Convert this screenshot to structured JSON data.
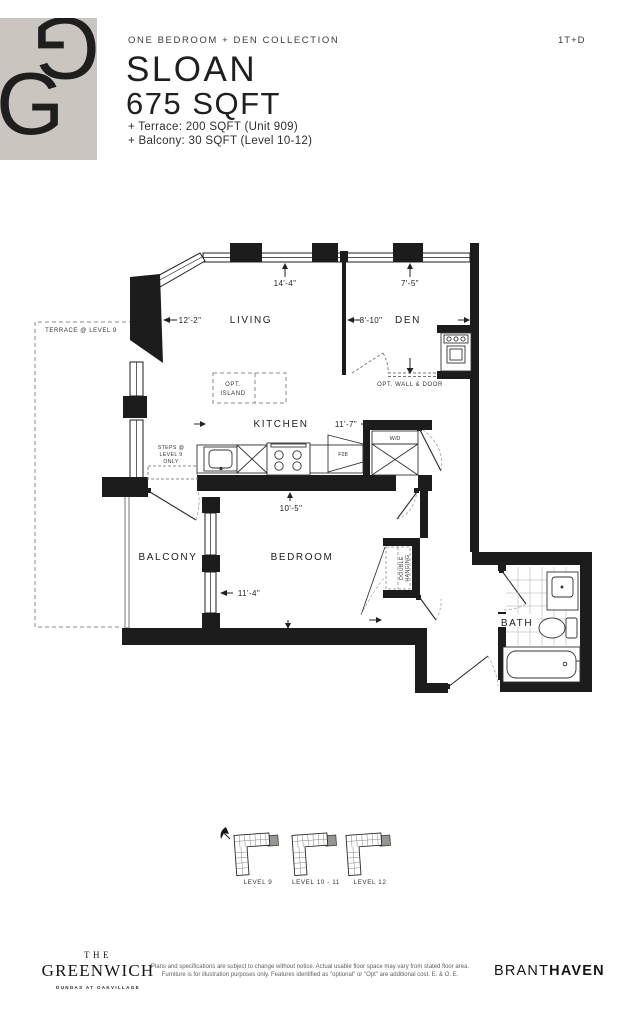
{
  "header": {
    "collection": "ONE BEDROOM + DEN COLLECTION",
    "plan_type": "1T+D",
    "name": "SLOAN",
    "area": "675 SQFT",
    "terrace_note": "+ Terrace: 200 SQFT (Unit 909)",
    "balcony_note": "+ Balcony: 30 SQFT (Level 10-12)",
    "logo_color": "#cac5bf"
  },
  "plan": {
    "rooms": {
      "living": "LIVING",
      "den": "DEN",
      "kitchen": "KITCHEN",
      "bedroom": "BEDROOM",
      "balcony": "BALCONY",
      "bath": "BATH"
    },
    "dims": {
      "living_width": "14'-4\"",
      "den_width": "7'-5\"",
      "living_depth": "12'-2\"",
      "den_depth": "8'-10\"",
      "kitchen_width": "11'-7\"",
      "bedroom_depth": "10'-5\"",
      "bedroom_width": "11'-4\""
    },
    "notes": {
      "terrace": "TERRACE @ LEVEL 9",
      "steps_1": "STEPS @",
      "steps_2": "LEVEL 9",
      "steps_3": "ONLY",
      "island_1": "OPT.",
      "island_2": "ISLAND",
      "opt_wall": "OPT. WALL & DOOR",
      "wd": "W/D",
      "fridge": "F28",
      "closet_1": "DOUBLE",
      "closet_2": "HANGING"
    }
  },
  "keyplans": [
    {
      "label": "LEVEL 9"
    },
    {
      "label": "LEVEL 10 - 11"
    },
    {
      "label": "LEVEL 12"
    }
  ],
  "footer": {
    "brand_top": "THE",
    "brand_name": "GREENWICH",
    "brand_sub": "DUNDAS AT OAKVILLAGE",
    "disclaimer_1": "Plans and specifications are subject to change without notice. Actual usable floor space may vary from stated floor area.",
    "disclaimer_2": "Furniture is for illustration purposes only. Features identified as \"optional\" or \"Opt\" are additional cost. E. & O. E.",
    "builder_1": "BRANT",
    "builder_2": "HAVEN"
  }
}
